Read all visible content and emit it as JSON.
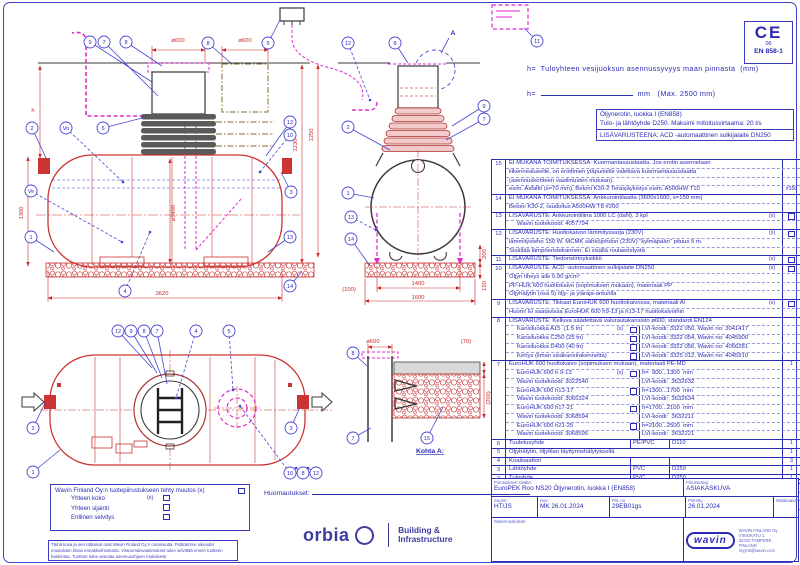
{
  "ce": {
    "mark": "CE",
    "number": "06",
    "standard": "EN 858-1"
  },
  "notes_top": {
    "h_def": "h=  Tuloyhteen vesijuoksun asennussyvyys maan pinnasta  (mm)",
    "h_label": "h=  ",
    "h_suffix": "  mm   (Max. 2500 mm)"
  },
  "info_box": {
    "line1": "Öljynerotin, luokka I (EN858)",
    "line2": "Tulo- ja lähtöyhde D250. Maksimi mitoitusvirtaama:  20 l/s",
    "line3": "LISÄVARUSTEENA: ACD -automaattinen sulkijalaite DN250"
  },
  "parts": {
    "rows": [
      {
        "no": "15",
        "lines": [
          {
            "t": "EI MUKANA TOIMITUKSESSA: Kuormantasauslaatta. Jos erotin asennetaan"
          },
          {
            "t": "liikennealueelle, on erottimen yläpuolelle valettava kuormantasauslaatta"
          },
          {
            "t": "(asennuskohteen vaatimusten mukaan)."
          },
          {
            "t": "esim. Asfaltti (s=70 mm), Betoni K30-2 Teräsjäykistys esim. A500HW T10",
            "q": "#150"
          }
        ]
      },
      {
        "no": "14",
        "lines": [
          {
            "t": "EI MUKANA TOIMITUKSESSA: Ankkurointilaatta (3600x1600, s=150 mm)"
          },
          {
            "t": "Betoni K30-2, raudoitus A500HW T8 #200"
          }
        ]
      },
      {
        "no": "13",
        "lines": [
          {
            "t": "LISÄVARUSTE: Ankkurointiliina 1000 LC (daN), 3 kpl",
            "xm": "(x)",
            "qcb": true
          },
          {
            "t": "Wavin tuotekoodi: 4057794",
            "ind": true
          }
        ]
      },
      {
        "no": "12",
        "lines": [
          {
            "t": "LISÄVARUSTE: Huoltokaivon lämmityssarja (230V)",
            "xm": "(x)",
            "qcb": true
          },
          {
            "t": "lämmitysteho 150 W. MCMK sähköjohdon (230V) \"kylmäpään\" pituus 5 m."
          },
          {
            "t": "Sisältää lämpöeristekannen. Ei sisällä routaeristystä"
          }
        ]
      },
      {
        "no": "11",
        "lines": [
          {
            "t": "LISÄVARUSTE: Tiedonsiirtoyksikkö",
            "xm": "(x)",
            "qcb": true
          }
        ]
      },
      {
        "no": "10",
        "lines": [
          {
            "t": "LISÄVARUSTE: ACD -automaattinen sulkijalaite DN250",
            "xm": "(x)",
            "qcb": true
          },
          {
            "t": "Öljyn tiheys alle 0,90 g/cm³"
          },
          {
            "t": "PP-HUK 600 huoltokaivo (sopimuksen mukaan), materiaali PP"
          },
          {
            "t": "Öljyhälytin (osa 5) öljy- ja yläraja-anturilla"
          }
        ]
      },
      {
        "no": "9",
        "lines": [
          {
            "t": "LISÄVARUSTE: Tikkaat EuroHUK 600 huoltokaivossa, materiaali Al",
            "xm": "(x)",
            "qcb": true
          },
          {
            "t": "Huom! Ei saatavissa EuroHUK 600 h9-13 ja h13-17 huoltokaivoihin"
          }
        ]
      },
      {
        "no": "8",
        "lines": [
          {
            "t": "LISÄVARUSTE: Kelluva säädettävä valurautakansisto ⌀600, standardi EN124"
          },
          {
            "t": "Kansiluokka A15  (1.5 tn)",
            "xm": "(x)",
            "cb": true,
            "r": "LVI-koodi: 3322 050, Wavin no: 3041417",
            "ind": true
          },
          {
            "t": "Kansiluokka C250 (25 tn)",
            "cb": true,
            "r": "LVI-koodi: 3322 054, Wavin no: 4045900",
            "ind": true
          },
          {
            "t": "Kansiluokka D400 (40 tn)",
            "cb": true,
            "r": "LVI-koodi: 3322 056, Wavin no: 4056281",
            "ind": true
          },
          {
            "t": "Kehys (ilman sisäkansirakennetta)",
            "cb": true,
            "r": "LVI-koodi: 3325 012, Wavin no: 4045910",
            "ind": true
          }
        ]
      },
      {
        "no": "7",
        "lines": [
          {
            "t": "EuroHUK 600 huoltokaivo (sopimuksen mukaan), materiaali PE-MD",
            "q": "1"
          },
          {
            "t": "EuroHUK 600 h 9-13",
            "xm": "(x)",
            "cb": true,
            "r": "h=  900...1300  mm",
            "ind": true
          },
          {
            "t": "Wavin tuotekoodi: 3022540",
            "r": "LVI-koodi:  3632632",
            "ind": true
          },
          {
            "t": "EuroHUK 600 h13-17",
            "cb": true,
            "r": "h=1300...1700  mm",
            "ind": true
          },
          {
            "t": "Wavin tuotekoodi: 3065324",
            "r": "LVI-koodi:  3632634",
            "ind": true
          },
          {
            "t": "EuroHUK 600 h17-21",
            "cb": true,
            "r": "h=1700...2100  mm",
            "ind": true
          },
          {
            "t": "Wavin tuotekoodi: 3068594",
            "r": "LVI-koodi:  3632211",
            "ind": true
          },
          {
            "t": "EuroHUK 600 h21-25",
            "cb": true,
            "r": "h=2100...2500  mm",
            "ind": true
          },
          {
            "t": "Wavin tuotekoodi: 3068595",
            "r": "LVI-koodi:  3632221",
            "ind": true
          }
        ]
      },
      {
        "no": "6",
        "lines": [
          {
            "t": "Tuuletusyhde",
            "c2": "PE/PVC",
            "c3": "D110",
            "q": "1"
          }
        ]
      },
      {
        "no": "5",
        "lines": [
          {
            "t": "Öljyhälytin, öljytilan täyttymishälytyksellä",
            "q": "1"
          }
        ]
      },
      {
        "no": "4",
        "lines": [
          {
            "t": "Koalisaattori",
            "c2": "",
            "c3": "",
            "q": "3"
          }
        ]
      },
      {
        "no": "3",
        "lines": [
          {
            "t": "Lähtöyhde",
            "c2": "PVC",
            "c3": "D250",
            "q": "1"
          }
        ]
      },
      {
        "no": "2",
        "lines": [
          {
            "t": "Tuloyhde",
            "c2": "PVC",
            "c3": "D250",
            "q": "1"
          }
        ]
      },
      {
        "no": "1",
        "lines": [
          {
            "t": "Lujitemuovirunko  (LM)",
            "c2": "",
            "c3": "⌀1400, L=3620 mm",
            "q": "1"
          },
          {
            "t": "pH 3-10/Lämpötilankesto max.  50°C"
          },
          {
            "t": "Ve      Tehollinen  tilavuus",
            "c3": "4 450 l",
            "ind": true
          },
          {
            "t": "Vo      Öljyn  varastotilavuus",
            "c3": "520 l",
            "ind": true
          }
        ]
      }
    ]
  },
  "title_block": {
    "content_label": "Piirustuksen sisältö:",
    "content": "EuroPEK Roo NS20 Öljynerotin, luokka I (EN858)",
    "type_label": "Piirustuslaji:",
    "type": "ASIAKASKUVA",
    "suunn_label": "Suunn:",
    "suunn": "HT/JS",
    "hyv_label": "Hyv:",
    "hyv": "MK 26.01.2024",
    "piirno_label": "Piir. no",
    "piirno": "29EB01gs",
    "piirretty_label": "Piirretty",
    "piirretty": "26.01.2024",
    "mittakaava_label": "Mittakaava:",
    "mittakaava": "",
    "rakennuskohde_label": "Rakennuskohde:",
    "wavin_logo": "wavin",
    "wavin_address": [
      "WAVIN FINLAND Oy",
      "VISIOKATU 1",
      "33720 TAMPERE",
      "FINLAND",
      "myynti@wavin.com"
    ]
  },
  "changes_box": {
    "title": "Wavin Finland Oy:n tuotepiirustukseen tehty muutos (x)",
    "items": [
      {
        "t": "Yhteen koko",
        "x": "(x)"
      },
      {
        "t": "Yhteen sijainti",
        "x": ""
      },
      {
        "t": "Erillinen selvitys",
        "x": ""
      }
    ]
  },
  "disclaimer": {
    "l1": "Tämä kuva ja sen ratkaisut ovat Wavin Finland Oy:n omaisuutta. Pidätämme oikeudet",
    "l2": "muutoksiin ilman ennakkoilmoitusta. Viranomaisvaatimukset tulee selvittää ennen tuotteen",
    "l3": "hankintaa. Tuotteet tulee asentaa asennusohjeen mukaisesti"
  },
  "notes_label": "Huomautukset:",
  "orbia": {
    "name": "orbia",
    "division1": "Building &",
    "division2": "Infrastructure"
  },
  "drawing": {
    "callouts": [
      {
        "n": "9",
        "x": 90,
        "y": 42,
        "tx": 152,
        "ty": 82
      },
      {
        "n": "7",
        "x": 104,
        "y": 42,
        "tx": 158,
        "ty": 96
      },
      {
        "n": "8",
        "x": 126,
        "y": 42,
        "tx": 162,
        "ty": 66
      },
      {
        "n": "8",
        "x": 208,
        "y": 43,
        "tx": 232,
        "ty": 64
      },
      {
        "n": "2",
        "x": 32,
        "y": 128,
        "tx": 46,
        "ty": 158
      },
      {
        "n": "Vo",
        "x": 66,
        "y": 128,
        "tx": 123,
        "ty": 182,
        "d": 1
      },
      {
        "n": "6",
        "x": 103,
        "y": 128,
        "tx": 146,
        "ty": 117
      },
      {
        "n": "Ve",
        "x": 31,
        "y": 191,
        "tx": 122,
        "ty": 242,
        "d": 1
      },
      {
        "n": "1",
        "x": 31,
        "y": 237,
        "tx": 54,
        "ty": 252
      },
      {
        "n": "4",
        "x": 125,
        "y": 291,
        "tx": 150,
        "ty": 232,
        "d": 1
      },
      {
        "n": "12",
        "x": 290,
        "y": 122,
        "tx": 266,
        "ty": 156
      },
      {
        "n": "10",
        "x": 290,
        "y": 135,
        "tx": 260,
        "ty": 172,
        "d": 1
      },
      {
        "n": "3",
        "x": 291,
        "y": 192,
        "tx": 281,
        "ty": 172
      },
      {
        "n": "13",
        "x": 290,
        "y": 237,
        "tx": 268,
        "ty": 252
      },
      {
        "n": "14",
        "x": 290,
        "y": 286,
        "tx": 302,
        "ty": 271
      },
      {
        "n": "5",
        "x": 268,
        "y": 43,
        "tx": 280,
        "ty": 20
      },
      {
        "n": "12",
        "x": 348,
        "y": 43,
        "tx": 370,
        "ty": 100,
        "d": 1
      },
      {
        "n": "8",
        "x": 395,
        "y": 43,
        "tx": 408,
        "ty": 63
      },
      {
        "n": "9",
        "x": 484,
        "y": 106,
        "tx": 452,
        "ty": 126
      },
      {
        "n": "7",
        "x": 484,
        "y": 119,
        "tx": 446,
        "ty": 140
      },
      {
        "n": "2",
        "x": 348,
        "y": 127,
        "tx": 390,
        "ty": 150
      },
      {
        "n": "1",
        "x": 348,
        "y": 193,
        "tx": 374,
        "ty": 198
      },
      {
        "n": "13",
        "x": 351,
        "y": 217,
        "tx": 376,
        "ty": 230,
        "d": 1
      },
      {
        "n": "14",
        "x": 351,
        "y": 239,
        "tx": 370,
        "ty": 266
      },
      {
        "n": "11",
        "x": 537,
        "y": 41,
        "tx": 524,
        "ty": 28
      },
      {
        "n": "12",
        "x": 118,
        "y": 331,
        "tx": 152,
        "ty": 368
      },
      {
        "n": "9",
        "x": 131,
        "y": 331,
        "tx": 157,
        "ty": 373
      },
      {
        "n": "8",
        "x": 144,
        "y": 331,
        "tx": 162,
        "ty": 378
      },
      {
        "n": "7",
        "x": 157,
        "y": 331,
        "tx": 167,
        "ty": 384
      },
      {
        "n": "4",
        "x": 196,
        "y": 331,
        "tx": 176,
        "ty": 398,
        "d": 1
      },
      {
        "n": "5",
        "x": 229,
        "y": 331,
        "tx": 233,
        "ty": 390,
        "d": 1
      },
      {
        "n": "2",
        "x": 33,
        "y": 428,
        "tx": 45,
        "ty": 403
      },
      {
        "n": "1",
        "x": 33,
        "y": 472,
        "tx": 60,
        "ty": 450
      },
      {
        "n": "3",
        "x": 291,
        "y": 428,
        "tx": 299,
        "ty": 409
      },
      {
        "n": "10",
        "x": 290,
        "y": 473,
        "tx": 240,
        "ty": 406,
        "d": 1
      },
      {
        "n": "8",
        "x": 303,
        "y": 473,
        "tx": 296,
        "ty": 468,
        "d": 1
      },
      {
        "n": "12",
        "x": 316,
        "y": 473,
        "tx": 308,
        "ty": 468,
        "d": 1
      },
      {
        "n": "8",
        "x": 353,
        "y": 353,
        "tx": 367,
        "ty": 366
      },
      {
        "n": "7",
        "x": 353,
        "y": 438,
        "tx": 371,
        "ty": 428
      },
      {
        "n": "15",
        "x": 427,
        "y": 438,
        "tx": 443,
        "ty": 407
      }
    ],
    "dims": [
      {
        "t": "⌀600",
        "x": 178,
        "y": 42
      },
      {
        "t": "⌀600",
        "x": 245,
        "y": 42
      },
      {
        "t": "h",
        "x": 33,
        "y": 112
      },
      {
        "t": "1300",
        "x": 23,
        "y": 213,
        "r": -90
      },
      {
        "t": "⌀1400",
        "x": 175,
        "y": 213,
        "r": -90
      },
      {
        "t": "1230",
        "x": 297,
        "y": 145,
        "r": -90
      },
      {
        "t": "1250",
        "x": 313,
        "y": 135,
        "r": -90
      },
      {
        "t": "3620",
        "x": 162,
        "y": 295
      },
      {
        "t": "(100)",
        "x": 349,
        "y": 291
      },
      {
        "t": "1400",
        "x": 418,
        "y": 285
      },
      {
        "t": "1600",
        "x": 418,
        "y": 299
      },
      {
        "t": "200",
        "x": 486,
        "y": 254,
        "r": -90
      },
      {
        "t": "150",
        "x": 486,
        "y": 286,
        "r": -90
      },
      {
        "t": "⌀600",
        "x": 373,
        "y": 343
      },
      {
        "t": "(70)",
        "x": 466,
        "y": 343
      },
      {
        "t": "(200)",
        "x": 490,
        "y": 398,
        "r": -90
      },
      {
        "t": "A",
        "x": 453,
        "y": 35,
        "c": 1
      },
      {
        "t": "Kohta A:",
        "x": 430,
        "y": 453,
        "c": 1,
        "u": 1
      }
    ]
  }
}
